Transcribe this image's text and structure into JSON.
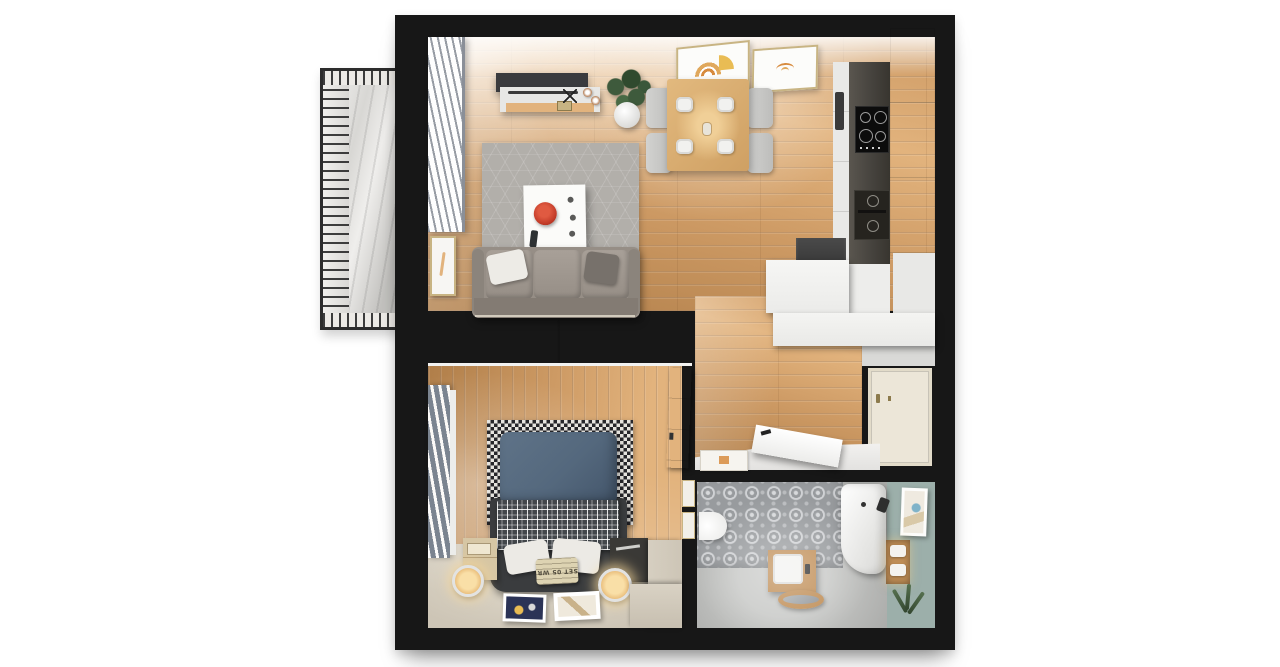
{
  "meta": {
    "title": "apartment-floor-plan-top-down-render",
    "view": "top-down 3d render",
    "style": "photorealistic floor plan on white background"
  },
  "palette": {
    "bg": "#ffffff",
    "wall": "#171717",
    "wood-base": "#cd9a64",
    "wood-hi": "#e2b37d",
    "wood-lo": "#b07e49",
    "rug": "#b2afaa",
    "sofa": "#968e86",
    "sofa-dark": "#837b73",
    "cushion": "#a8a098",
    "wardrobe": "#d4d5d3",
    "carpet": "#cdc5b6",
    "carpet-hi": "#dbd4c5",
    "duvet": "#54687d",
    "plaid": "#43474b",
    "bedframe": "#3a3c3e",
    "pillow": "#eceae5",
    "tile-bg": "#989b9e",
    "tile-dot": "#d7d9db",
    "bath-floor": "#a8a9a7",
    "bath-floor-hi": "#c9cac8",
    "teal": "#9cafaa",
    "vanity-wood": "#bf8d55",
    "cream-cab": "#e9e3d5",
    "counter-dark": "#46433e",
    "door-cream": "#ece6d8",
    "gray-band": "#d9d9d7",
    "gold": "#c8b483",
    "orange": "#d78b3e",
    "red": "#c23b28",
    "green": "#3e5a3c",
    "curtain-gray": "#7b8490",
    "concrete": "#dcdbd8"
  },
  "rooms": {
    "living_room": {
      "label": "living room",
      "furniture": [
        "sofa",
        "coffee-table",
        "hex-rug",
        "tv",
        "tv-console",
        "potted-plant",
        "window-curtains",
        "wall-picture",
        "ceiling-light-frames"
      ]
    },
    "dining_area": {
      "label": "dining area",
      "furniture": [
        "wood-dining-table",
        "four-chairs",
        "four-plates"
      ]
    },
    "kitchen": {
      "label": "kitchen",
      "furniture": [
        "cream-tall-cabinets",
        "dark-countertop",
        "induction-hob",
        "double-oven",
        "fridge",
        "white-cabinets"
      ]
    },
    "hallway": {
      "label": "hallway",
      "furniture": [
        "entrance-door",
        "open-interior-door",
        "doormat"
      ]
    },
    "bedroom": {
      "label": "bedroom",
      "furniture": [
        "wardrobe",
        "double-bed",
        "checkered-rug",
        "nightstands",
        "glowing-lamps",
        "floor-posters",
        "window-curtains",
        "radiator",
        "door",
        "platform"
      ]
    },
    "bathroom": {
      "label": "bathroom",
      "furniture": [
        "patterned-tile-floor",
        "toilet",
        "wood-vanity-sink",
        "oval-mirror",
        "bathtub",
        "teal-accent-wall",
        "wall-picture",
        "towel-shelf",
        "plant"
      ]
    },
    "balcony": {
      "label": "balcony",
      "furniture": [
        "metal-railing",
        "concrete-floor"
      ]
    }
  },
  "bed": {
    "pillow_print": "SET 05 WR"
  }
}
